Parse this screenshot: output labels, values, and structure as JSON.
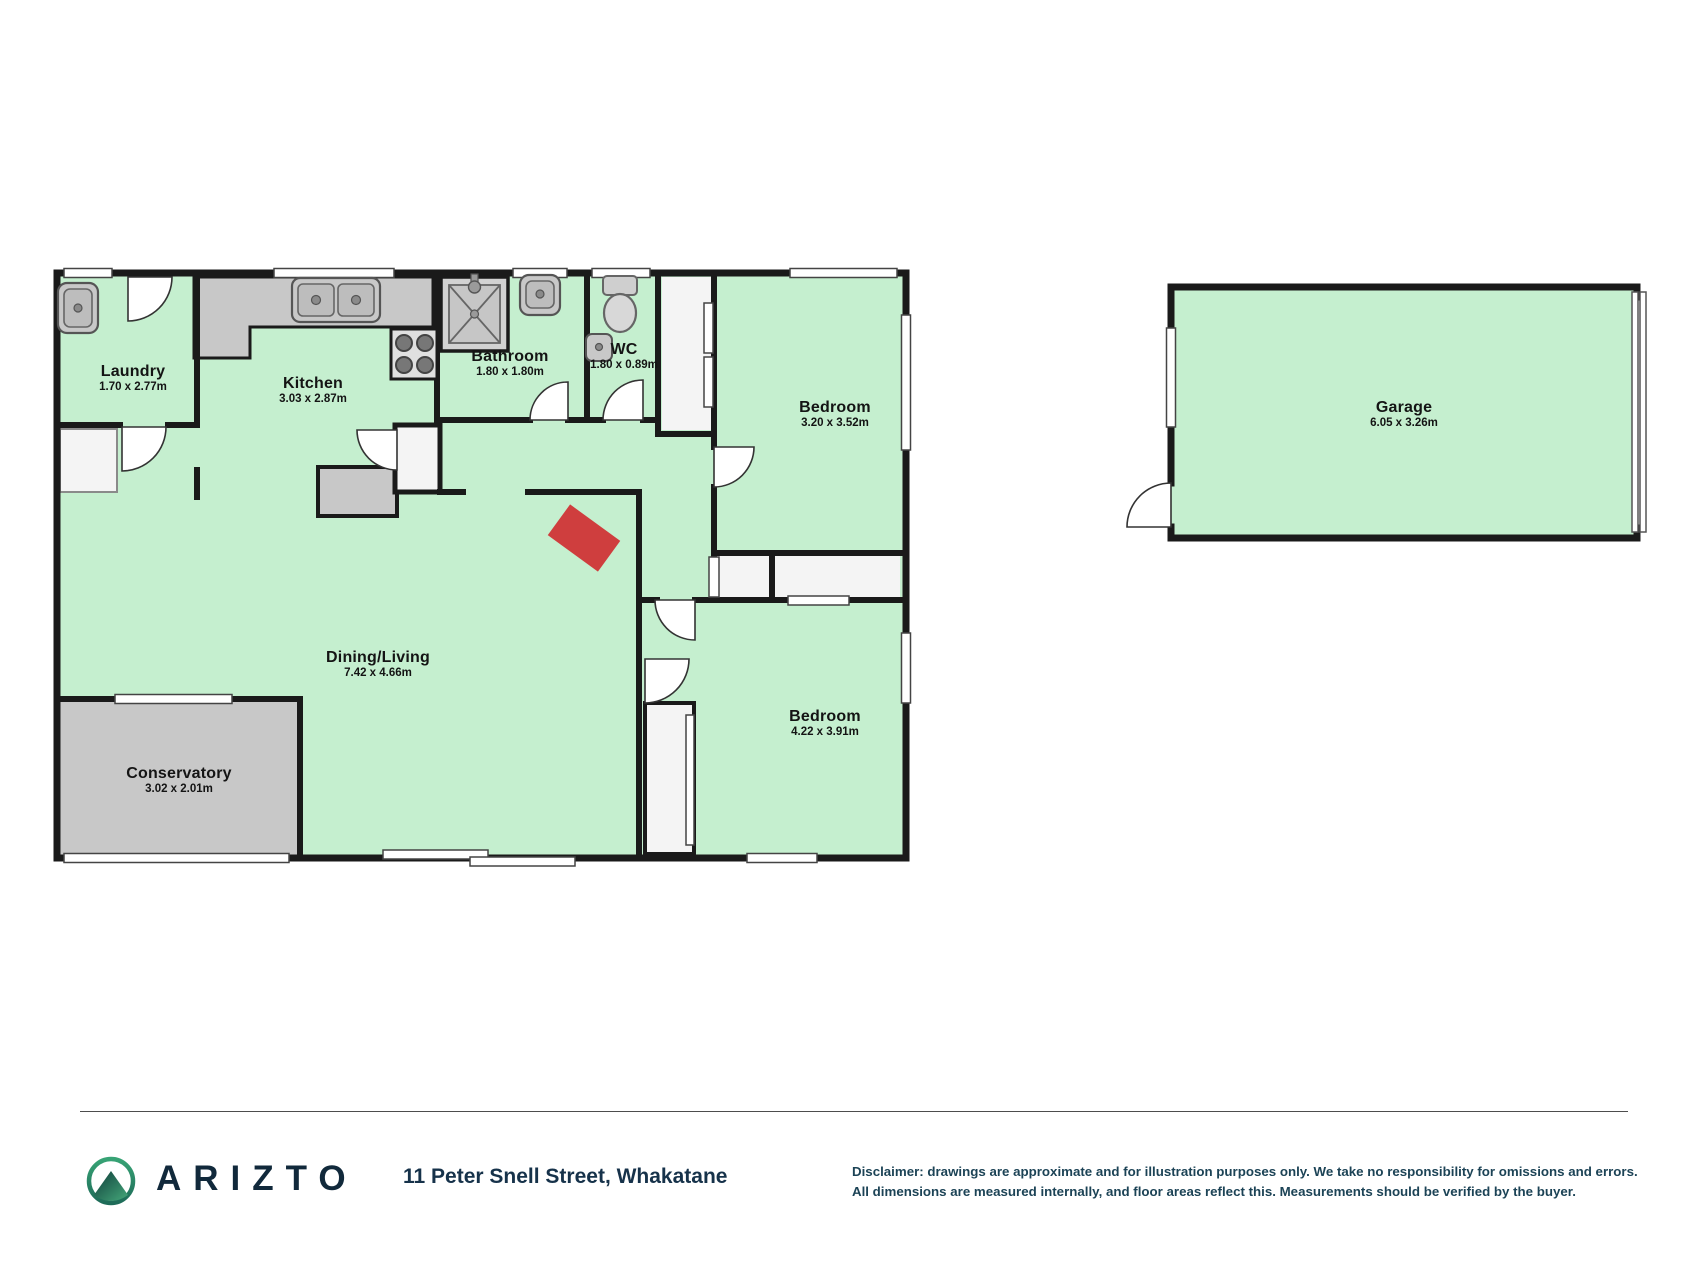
{
  "floorplan": {
    "rooms": [
      {
        "name": "Laundry",
        "dims": "1.70 x 2.77m"
      },
      {
        "name": "Kitchen",
        "dims": "3.03 x 2.87m"
      },
      {
        "name": "Bathroom",
        "dims": "1.80 x 1.80m"
      },
      {
        "name": "WC",
        "dims": "1.80 x 0.89m"
      },
      {
        "name": "Bedroom",
        "dims": "3.20 x 3.52m"
      },
      {
        "name": "Dining/Living",
        "dims": "7.42 x 4.66m"
      },
      {
        "name": "Conservatory",
        "dims": "3.02 x 2.01m"
      },
      {
        "name": "Bedroom",
        "dims": "4.22 x 3.91m"
      },
      {
        "name": "Garage",
        "dims": "6.05 x 3.26m"
      }
    ],
    "colors": {
      "floor_green": "#c5efcf",
      "hard_gray": "#c8c8c8",
      "wall_black": "#1a1a1a",
      "burner_red": "#cf3e3e"
    }
  },
  "footer": {
    "brand": "ARIZTO",
    "address": "11 Peter Snell Street, Whakatane",
    "disclaimer_line1": "Disclaimer: drawings are approximate and for illustration purposes only. We take no responsibility for omissions and errors.",
    "disclaimer_line2": "All dimensions are measured internally, and floor areas reflect this. Measurements should be verified by the buyer."
  }
}
